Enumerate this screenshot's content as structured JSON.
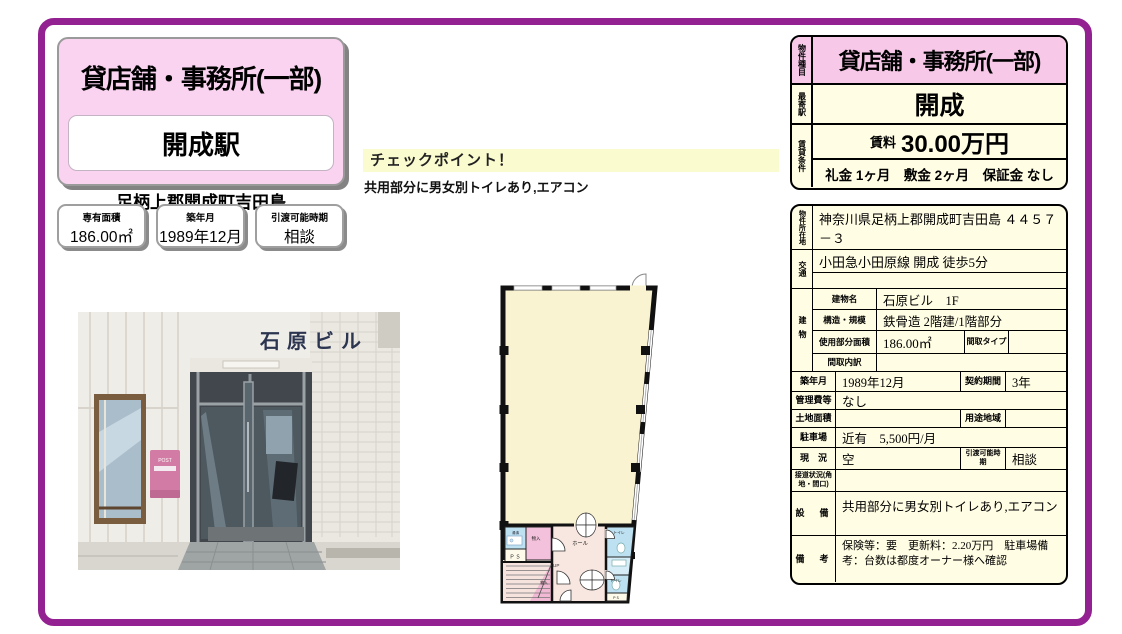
{
  "colors": {
    "frame": "#942191",
    "pink_box": "#F9D3F0",
    "pink_row": "#F7C8E8",
    "cream": "#FFFDE3",
    "checkpoint_yellow": "#FBFBD0"
  },
  "left_panel": {
    "property_type": "貸店舗・事務所(一部)",
    "station": "開成駅",
    "address": "足柄上郡開成町吉田島",
    "stats": [
      {
        "label": "専有面積",
        "value": "186.00㎡"
      },
      {
        "label": "築年月",
        "value": "1989年12月"
      },
      {
        "label": "引渡可能時期",
        "value": "相談"
      }
    ]
  },
  "checkpoint": {
    "title": "チェックポイント！",
    "body": "共用部分に男女別トイレあり,エアコン"
  },
  "photo": {
    "sign": "石原ビル",
    "mailbox_label": "POST"
  },
  "floorplan": {
    "labels": {
      "kitchenette": "湯沸",
      "ps_left": "ＰＳ",
      "storage_upper": "物入",
      "hall": "ホール",
      "toilet_upper": "トイレ",
      "toilet_lower": "トイレ",
      "ps_right": "ＰＳ",
      "up": "UP",
      "storage_stairs": "物入"
    }
  },
  "summary_table": {
    "type_label": "物件種目",
    "type_value": "貸店舗・事務所(一部)",
    "station_label": "最寄駅",
    "station_value": "開成",
    "terms_label": "賃貸条件",
    "rent_label": "賃料",
    "rent_value": "30.00万円",
    "terms_value": "礼金 1ヶ月　敷金 2ヶ月　保証金 なし"
  },
  "detail_table": {
    "location_label": "物件所在地",
    "location_value": "神奈川県足柄上郡開成町吉田島 ４４５７－３",
    "traffic_label": "交通",
    "traffic_value": "小田急小田原線 開成 徒歩5分",
    "building_label": "建物",
    "building_name_label": "建物名",
    "building_name_value": "石原ビル　1F",
    "structure_label": "構造・規模",
    "structure_value": "鉄骨造 2階建/1階部分",
    "use_area_label": "使用部分面積",
    "use_area_value": "186.00㎡",
    "layout_type_label": "間取タイプ",
    "layout_detail_label": "間取内訳",
    "built_label": "築年月",
    "built_value": "1989年12月",
    "contract_label": "契約期間",
    "contract_value": "3年",
    "management_label": "管理費等",
    "management_value": "なし",
    "land_label": "土地面積",
    "zoning_label": "用途地域",
    "parking_label": "駐車場",
    "parking_value": "近有　5,500円/月",
    "status_label": "現　況",
    "status_value": "空",
    "handover_label": "引渡可能時期",
    "handover_value": "相談",
    "road_label": "接道状況(角地・間口)",
    "equipment_label": "設　備",
    "equipment_value": "共用部分に男女別トイレあり,エアコン",
    "notes_label": "備　考",
    "notes_value": "保険等：要　更新料：2.20万円　駐車場備考：台数は都度オーナー様へ確認"
  }
}
